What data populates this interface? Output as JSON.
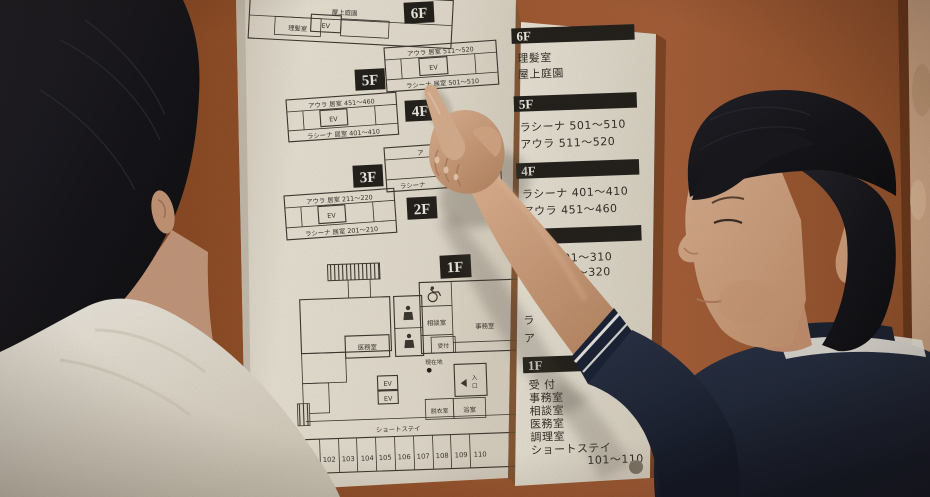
{
  "scene": {
    "description": "Two people in front of a wall-mounted facility floor directory sign",
    "colors": {
      "wall": "#9c552b",
      "pillar": "#c9a283",
      "panel": "#e9e3d6",
      "ink": "#35312a",
      "badge_bg": "#26231e",
      "badge_text": "#f2efe7",
      "navy_shirt": "#222939",
      "white_shirt": "#ece7dc",
      "hair": "#17161a",
      "skin": "#d2a481"
    }
  },
  "plans": {
    "f6": {
      "badge": "6F",
      "roof": "屋上庭園",
      "barber": "理髪室",
      "ev": "EV"
    },
    "f5": {
      "badge": "5F",
      "top": "アウラ 居室 511〜520",
      "ev": "EV",
      "bottom": "ラシーナ 居室 501〜510"
    },
    "f4": {
      "badge": "4F",
      "top": "アウラ 居室 451〜460",
      "ev": "EV",
      "bottom": "ラシーナ 居室 401〜410"
    },
    "f3": {
      "badge": "3F",
      "top_fragment": "ア",
      "bottom_fragment": "ラシーナ"
    },
    "f2": {
      "badge": "2F",
      "top": "アウラ 居室 211〜220",
      "ev": "EV",
      "bottom": "ラシーナ 居室 201〜210"
    },
    "f1": {
      "badge": "1F",
      "consult": "相談室",
      "office": "事務室",
      "medical": "医務室",
      "reception": "受付",
      "location": "現在地",
      "ev1": "EV",
      "ev2": "EV",
      "entrance": [
        "入",
        "口"
      ],
      "dressing": "脱衣室",
      "bath": "浴室",
      "short_stay": "ショートステイ",
      "numbers": [
        "101",
        "102",
        "103",
        "104",
        "105",
        "106",
        "107",
        "108",
        "109",
        "110"
      ]
    }
  },
  "directory": {
    "sections": [
      {
        "badge": "6F",
        "lines": [
          "理髪室",
          "屋上庭園"
        ]
      },
      {
        "badge": "5F",
        "lines": [
          "ラシーナ 501〜510",
          "アウラ 511〜520"
        ]
      },
      {
        "badge": "4F",
        "lines": [
          "ラシーナ 401〜410",
          "アウラ 451〜460"
        ]
      },
      {
        "badge": "",
        "lines": [
          "ナ 301〜310",
          "ラ 311〜320"
        ]
      },
      {
        "badge": "",
        "lines": [
          "ラ",
          "ア"
        ]
      },
      {
        "badge": "1F",
        "lines": [
          "受 付",
          "事務室",
          "相談室",
          "医務室",
          "調理室",
          "ショートステイ",
          "101〜110"
        ]
      }
    ]
  }
}
